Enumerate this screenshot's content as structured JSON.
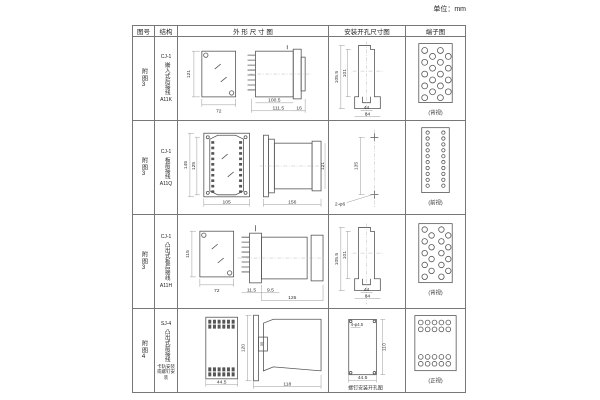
{
  "unit": "单位：mm",
  "headers": {
    "fig": "图号",
    "structure": "结构",
    "outline": "外 形 尺 寸 图",
    "install": "安装开孔尺寸图",
    "terminal": "端子图"
  },
  "rows": [
    {
      "fig": "附图3",
      "model": "CJ-1",
      "type": "嵌入式后接线",
      "code": "A11K",
      "outline": {
        "h": "121",
        "w": "72",
        "l1": "100.5",
        "l2": "111.5",
        "r": "16"
      },
      "install": {
        "v1": "105.5",
        "v2": "101",
        "b1": "44",
        "b2": "84"
      },
      "terminal": "(背视)"
    },
    {
      "fig": "附图3",
      "model": "CJ-1",
      "type": "板前接线",
      "code": "A11Q",
      "outline": {
        "v1": "145",
        "v2": "125",
        "b": "105",
        "len": "156",
        "r": "121"
      },
      "install": {
        "v": "135",
        "hole": "2-φ6"
      },
      "terminal": "(前视)"
    },
    {
      "fig": "附图3",
      "model": "CJ-1",
      "type": "凸出式板后接线",
      "code": "A11H",
      "outline": {
        "h": "115",
        "w": "72",
        "b1": "11.5",
        "b2": "9.5",
        "b3": "126"
      },
      "install": {
        "v1": "105.5",
        "v2": "101",
        "b1": "44",
        "b2": "84"
      },
      "terminal": "(背视)"
    },
    {
      "fig": "附图4",
      "model": "SJ-4",
      "type": "凸出式前接线",
      "note": "卡轨安装或螺钉安装",
      "outline": {
        "w": "44.5",
        "v": "120",
        "inner": "35",
        "b": "118"
      },
      "install": {
        "hole": "4-φ4.5",
        "v": "110",
        "b": "44.5",
        "caption": "螺钉安装开孔图"
      },
      "terminal": "(正视)"
    }
  ]
}
